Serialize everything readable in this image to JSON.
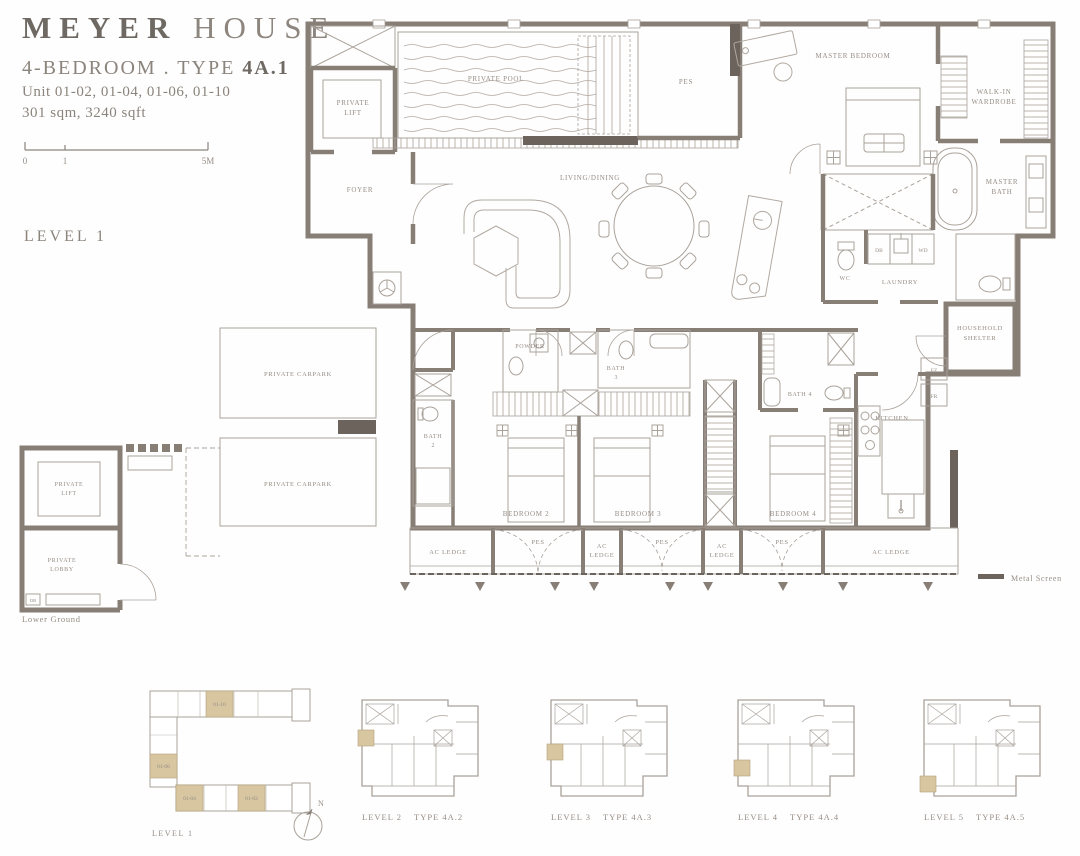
{
  "header": {
    "brand1": "MEYER",
    "brand2": "HOUSE",
    "type_prefix": "4-BEDROOM . TYPE ",
    "type_code": "4A.1",
    "units_line": "Unit 01-02, 01-04, 01-06, 01-10",
    "area_line": "301 sqm, 3240 sqft",
    "scale0": "0",
    "scale1": "1",
    "scale5": "5M",
    "level": "LEVEL 1"
  },
  "plan": {
    "private_lift1": "PRIVATE",
    "private_lift2": "LIFT",
    "foyer": "FOYER",
    "private_pool": "PRIVATE POOL",
    "pes": "PES",
    "master_bedroom": "MASTER BEDROOM",
    "walk_in1": "WALK-IN",
    "walk_in2": "WARDROBE",
    "master_bath1": "MASTER",
    "master_bath2": "BATH",
    "living_dining": "LIVING/DINING",
    "wc": "WC",
    "db": "DB",
    "wd": "WD",
    "laundry": "LAUNDRY",
    "household1": "HOUSEHOLD",
    "household2": "SHELTER",
    "powder": "POWDER",
    "bath2_1": "BATH",
    "bath2_2": "2",
    "bath3_1": "BATH",
    "bath3_2": "3",
    "bath4": "BATH 4",
    "fz": "FZ",
    "fr": "FR",
    "kitchen": "KITCHEN",
    "bedroom2": "BEDROOM 2",
    "bedroom3": "BEDROOM 3",
    "bedroom4": "BEDROOM 4",
    "ac_ledge": "AC LEDGE",
    "ac": "AC",
    "ledge": "LEDGE"
  },
  "legend": {
    "metal_screen": "Metal Screen"
  },
  "lower": {
    "carpark": "PRIVATE CARPARK",
    "lift1": "PRIVATE",
    "lift2": "LIFT",
    "lobby1": "PRIVATE",
    "lobby2": "LOBBY",
    "db": "DB",
    "caption": "Lower Ground"
  },
  "key": {
    "u_top": "01-10",
    "u_left": "01-06",
    "u_bl": "01-04",
    "u_br": "01-02",
    "level": "LEVEL 1",
    "north": "N"
  },
  "mini": [
    {
      "level": "LEVEL 2",
      "type": "TYPE 4A.2"
    },
    {
      "level": "LEVEL 3",
      "type": "TYPE 4A.3"
    },
    {
      "level": "LEVEL 4",
      "type": "TYPE 4A.4"
    },
    {
      "level": "LEVEL 5",
      "type": "TYPE 4A.5"
    }
  ],
  "colors": {
    "wall_gray": "#877e76",
    "line_gray": "#a9a29a",
    "label_gray": "#948d85",
    "dark_accent": "#6b635c",
    "unit_gold": "#d8c6a1",
    "background": "#ffffff"
  }
}
